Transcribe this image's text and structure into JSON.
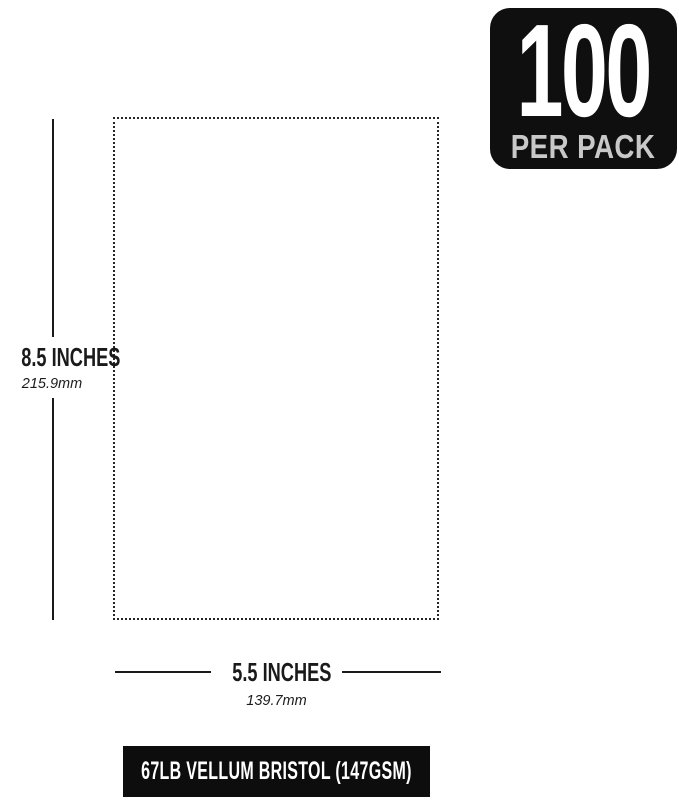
{
  "badge": {
    "count": "100",
    "label": "PER PACK"
  },
  "dimensions": {
    "height": {
      "label": "8.5 INCHES",
      "metric": "215.9mm"
    },
    "width": {
      "label": "5.5 INCHES",
      "metric": "139.7mm"
    }
  },
  "footer": {
    "label": "67LB VELLUM BRISTOL (147GSM)"
  },
  "colors": {
    "background": "#ffffff",
    "ink": "#1a1a1a",
    "badge_bg": "#0f0f0f",
    "badge_count_text": "#ffffff",
    "badge_sublabel_text": "#c8c8c8",
    "footer_bg": "#0d0d0d",
    "footer_text": "#ffffff",
    "outline_dots": "#262626"
  }
}
